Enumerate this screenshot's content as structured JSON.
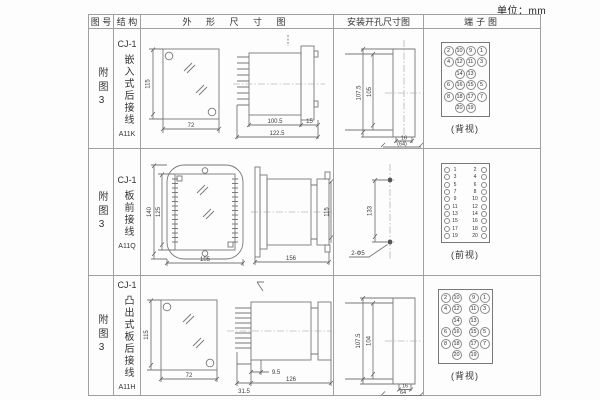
{
  "unit_label": "单位：mm",
  "table": {
    "headers": {
      "fig_no": "图 号",
      "structure": "结 构",
      "outline": "外 形 尺 寸 图",
      "install": "安装开孔尺寸图",
      "terminal": "端子图"
    },
    "rows": [
      {
        "fig_no": "附图3",
        "structure": {
          "model": "CJ-1",
          "mount": "嵌入式后接线",
          "code": "A11K"
        },
        "outline_dims": {
          "front_height": "115",
          "front_width": "72",
          "depth_body": "100.5",
          "depth_total": "122.5",
          "flange": "15"
        },
        "install_dims": {
          "outer_height": "107.5",
          "inner_height": "105",
          "slot_width": "16",
          "width_ref": "(64)"
        },
        "terminal": {
          "caption": "(背视)",
          "grid": [
            [
              "2",
              "10",
              "9",
              "1"
            ],
            [
              "4",
              "12",
              "11",
              "3"
            ],
            [
              "14",
              "13"
            ],
            [
              "6",
              "16",
              "15",
              "5"
            ],
            [
              "8",
              "18",
              "17",
              "7"
            ],
            [
              "20",
              "19"
            ]
          ]
        }
      },
      {
        "fig_no": "附图3",
        "structure": {
          "model": "CJ-1",
          "mount": "板前接线",
          "code": "A11Q"
        },
        "outline_dims": {
          "front_height_outer": "140",
          "front_height_inner": "125",
          "front_width": "105",
          "side_length": "156",
          "side_height": "115"
        },
        "install_dims": {
          "hole_pitch": "133",
          "hole_note": "2-Φ5"
        },
        "terminal": {
          "caption": "(前视)",
          "pairs": [
            [
              "1",
              "2"
            ],
            [
              "3",
              "4"
            ],
            [
              "5",
              "6"
            ],
            [
              "7",
              "8"
            ],
            [
              "9",
              "10"
            ],
            [
              "11",
              "12"
            ],
            [
              "13",
              "14"
            ],
            [
              "15",
              "16"
            ],
            [
              "17",
              "18"
            ],
            [
              "19",
              "20"
            ]
          ]
        }
      },
      {
        "fig_no": "附图3",
        "structure": {
          "model": "CJ-1",
          "mount": "凸出式板后接线",
          "code": "A11H"
        },
        "outline_dims": {
          "front_height": "115",
          "front_width": "72",
          "pin_depth": "31.5",
          "lip": "9.5",
          "body_length": "126"
        },
        "install_dims": {
          "outer_height": "107.5",
          "inner_height": "104",
          "slot_width": "16",
          "width_ref": "64"
        },
        "terminal": {
          "caption": "(背视)",
          "grid": [
            [
              "2",
              "10",
              "9",
              "1"
            ],
            [
              "4",
              "12",
              "11",
              "3"
            ],
            [
              "14",
              "13"
            ],
            [
              "6",
              "16",
              "15",
              "5"
            ],
            [
              "8",
              "18",
              "17",
              "7"
            ],
            [
              "20",
              "19"
            ]
          ]
        }
      }
    ]
  }
}
